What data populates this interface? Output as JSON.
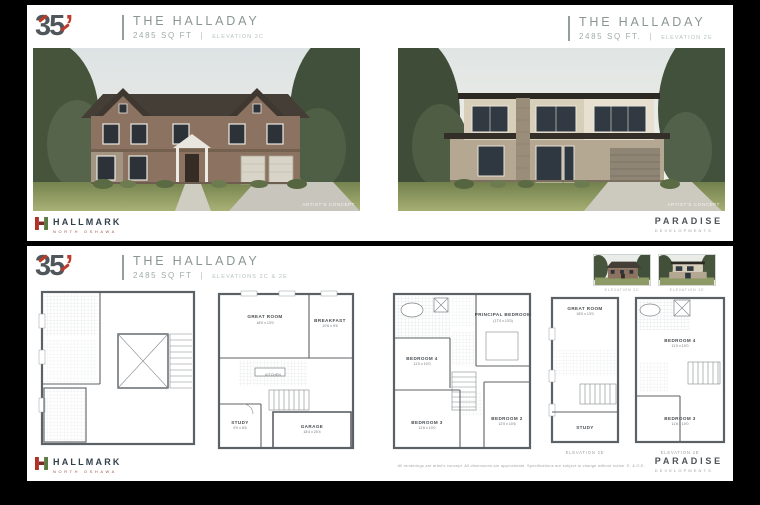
{
  "logo": {
    "number": "35",
    "apostrophe": "’"
  },
  "headers": {
    "top_left": {
      "title": "THE HALLADAY",
      "sqft": "2485 SQ FT",
      "sep": "|",
      "elevation": "ELEVATION 2C"
    },
    "top_right": {
      "title": "THE HALLADAY",
      "sqft": "2485 SQ FT.",
      "sep": "|",
      "elevation": "ELEVATION 2E"
    },
    "bottom": {
      "title": "THE HALLADAY",
      "sqft": "2485 SQ FT",
      "sep": "|",
      "elevation": "ELEVATIONS 2C & 2E"
    }
  },
  "renderings": {
    "left_caption": "ARTIST'S CONCEPT",
    "right_caption": "ARTIST'S CONCEPT"
  },
  "thumbnails": {
    "left_caption": "ELEVATION 2C",
    "right_caption": "ELEVATION 2E"
  },
  "brands": {
    "hallmark": {
      "name": "HALLMARK",
      "sub": "NORTH OSHAWA"
    },
    "paradise": {
      "name": "PARADISE",
      "sub": "DEVELOPMENTS"
    }
  },
  "disclaimer": "All renderings are artist's concept. All dimensions are approximate. Specifications are subject to change without notice. E. & O.E.",
  "plans": {
    "ground": {
      "great_room": {
        "label": "GREAT ROOM",
        "dims": "18'0 x 13'0"
      },
      "breakfast": {
        "label": "BREAKFAST",
        "dims": "10'6 x 9'6"
      },
      "kitchen": {
        "label": "KITCHEN"
      },
      "study": {
        "label": "STUDY",
        "dims": "9'0 x 8'6"
      },
      "garage": {
        "label": "GARAGE",
        "dims": "18'4 x 20'4"
      }
    },
    "second": {
      "principal": {
        "label": "PRINCIPAL BEDROOM",
        "dims": "(17'0 x 13'0)"
      },
      "bedroom4": {
        "label": "BEDROOM 4",
        "dims": "11'0 x 10'0"
      },
      "bedroom3": {
        "label": "BEDROOM 3",
        "dims": "11'6 x 10'0"
      },
      "bedroom2": {
        "label": "BEDROOM 2",
        "dims": "12'0 x 10'6"
      }
    },
    "alt_ground": {
      "great_room": {
        "label": "GREAT ROOM",
        "dims": "18'0 x 13'0"
      },
      "study": {
        "label": "STUDY"
      },
      "caption": "ELEVATION 2E"
    },
    "alt_second": {
      "bedroom4": {
        "label": "BEDROOM 4",
        "dims": "11'0 x 10'0"
      },
      "bedroom3": {
        "label": "BEDROOM 3",
        "dims": "11'6 x 10'0"
      },
      "caption": "ELEVATION 2E"
    }
  },
  "colors": {
    "background": "#000000",
    "panel": "#ffffff",
    "accent_red": "#bf3a2b",
    "title_teal": "#8a9791",
    "hallmark_navy": "#32404c",
    "paradise_gray": "#4d5357"
  }
}
